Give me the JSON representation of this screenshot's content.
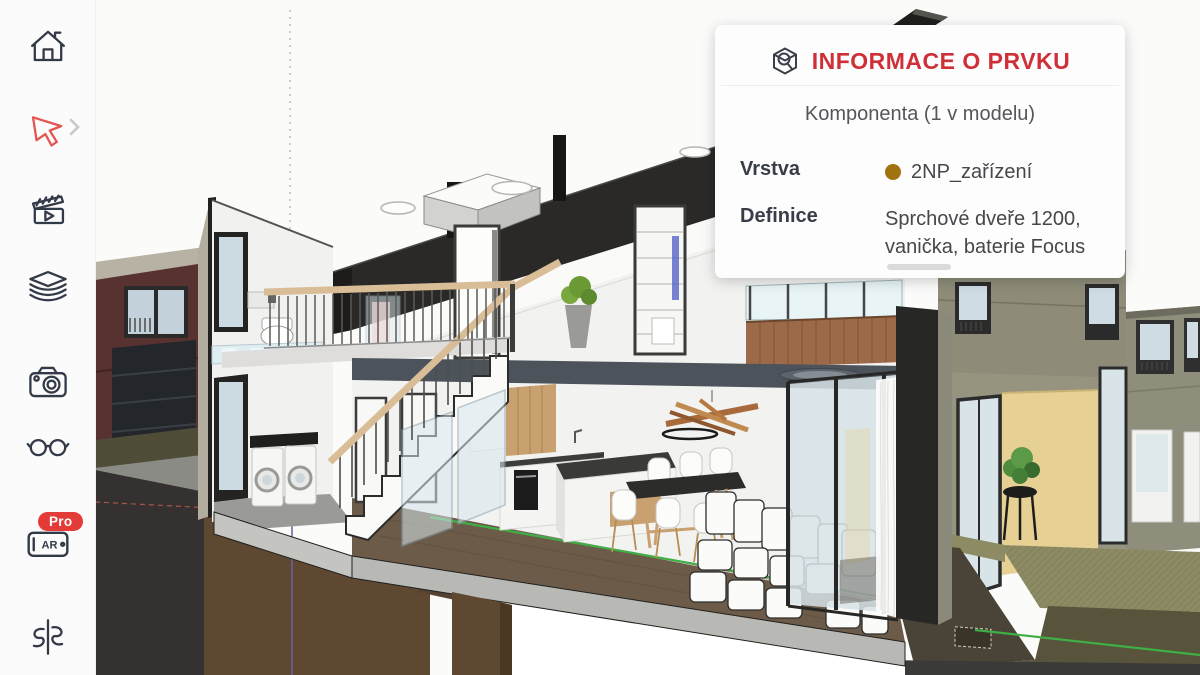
{
  "sidebar": {
    "icons": [
      "home-icon",
      "select-tool-icon",
      "scenes-icon",
      "layers-icon",
      "camera-icon",
      "look-around-icon",
      "ar-icon",
      "section-plane-icon"
    ],
    "ar_label": "AR",
    "pro_badge_label": "Pro",
    "active_tool": "select-tool-icon",
    "accent_color": "#e25550"
  },
  "info_panel": {
    "title": "INFORMACE O PRVKU",
    "component_summary": "Komponenta (1 v modelu)",
    "rows": [
      {
        "label": "Vrstva",
        "value": "2NP_zařízení",
        "dot_color": "#a2720e"
      },
      {
        "label": "Definice",
        "value": "Sprchové dveře 1200, vanička, baterie Focus"
      }
    ],
    "title_color": "#cf3038"
  },
  "viewport": {
    "description": "3D cross-section of a two-storey house model",
    "section_line_color": "#3fae45",
    "soil_color": "#5e4832",
    "roof_cut_color": "#2a2927",
    "neighbor_house_color": "#583230",
    "facade_color": "#8f8d7b",
    "patio_wall_color": "#e7d094",
    "handrail_color": "#d9bd97"
  }
}
